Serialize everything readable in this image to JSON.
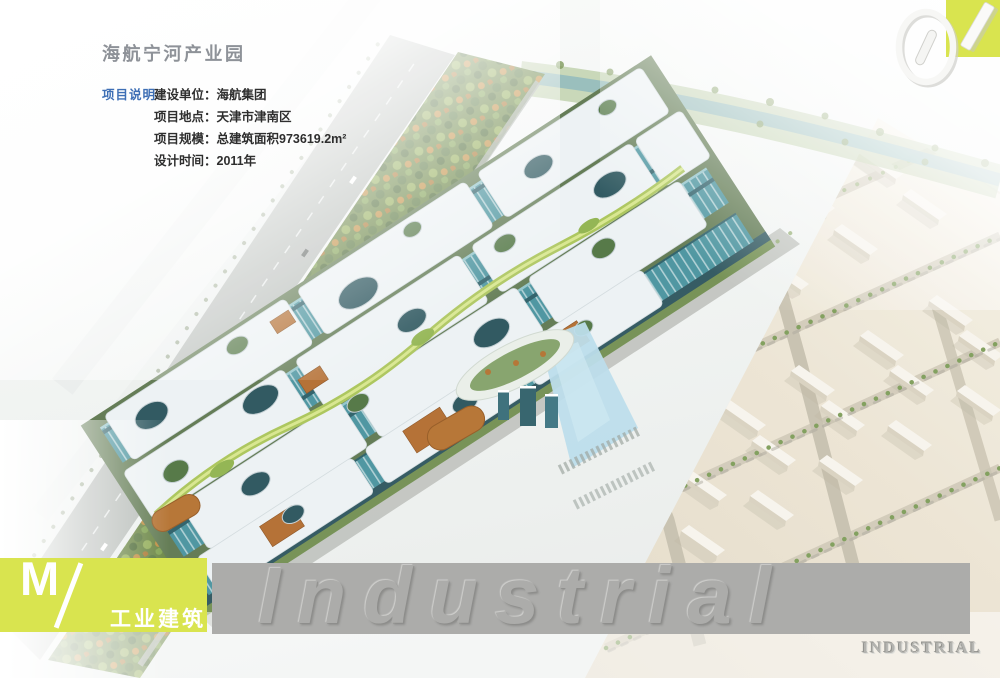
{
  "header": {
    "title": "海航宁河产业园",
    "section_label": "项目说明",
    "info": [
      {
        "label": "建设单位：",
        "value": "海航集团"
      },
      {
        "label": "项目地点：",
        "value": "天津市津南区"
      },
      {
        "label": "项目规模：",
        "value": "总建筑面积973619.2m²"
      },
      {
        "label": "设计时间：",
        "value": "2011年"
      }
    ]
  },
  "index_badge": {
    "number": "01"
  },
  "chapter": {
    "letter": "M",
    "separator": "/",
    "title": "工业建筑"
  },
  "footer": {
    "watermark": "Industrial",
    "corner_label": "INDUSTRIAL"
  },
  "colors": {
    "accent_yellow_green": "#d9e44f",
    "band_gray": "#acacaa",
    "title_gray": "#8e9298",
    "label_blue": "#3e6fb5",
    "body_text": "#2e2e2e",
    "canopy_white": "#eef3f4",
    "facade_teal": "#47929d",
    "tree_green": "#66823f",
    "ground_beige": "#e8e1cf",
    "water_blue": "#b9dcea"
  }
}
